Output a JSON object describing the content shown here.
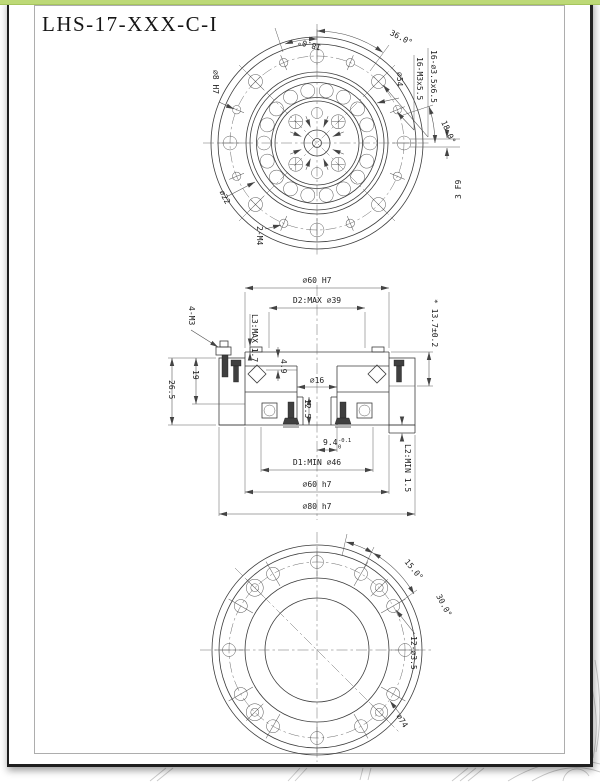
{
  "title": "LHS-17-XXX-C-I",
  "colors": {
    "accent_strip": "#bdd977",
    "page_border": "#1f1f1f",
    "frame_border": "#adadad",
    "line": "#3c3c3c",
    "faint_background_lines": "#c9c9c9"
  },
  "top_view": {
    "angle_top": "18.0°",
    "angle_arc": "36.0°",
    "bolt_circle": "⌀54",
    "holes_cbore": "16-⌀3.5x6.5",
    "holes_tapped": "16-M3x5.5",
    "angle_right": "18.0°",
    "keyway": "3 F9",
    "pin_hole": "⌀8 H7",
    "hub_dia": "⌀22",
    "tapped": "2-M4"
  },
  "section_view": {
    "dia_top": "⌀60 H7",
    "d2": "D2:MAX ⌀39",
    "l3": "L3:MAX 1.7",
    "screws": "4-M3",
    "h26_5": "26.5",
    "h19": "19",
    "h4_9": "4.9",
    "dia16": "⌀16",
    "h12_5": "12.5",
    "h13_7": "* 13.7±0.2",
    "h9_4": "9.4",
    "h9_4_sup": "-0.1",
    "h9_4_sub": "0",
    "d1": "D1:MIN ⌀46",
    "dia_mid": "⌀60 h7",
    "dia_outer": "⌀80 h7",
    "l2": "L2:MIN 1.5"
  },
  "bottom_view": {
    "angle15": "15.0°",
    "angle30": "30.0°",
    "holes": "12-⌀3.5",
    "bolt_circle": "⌀74"
  }
}
